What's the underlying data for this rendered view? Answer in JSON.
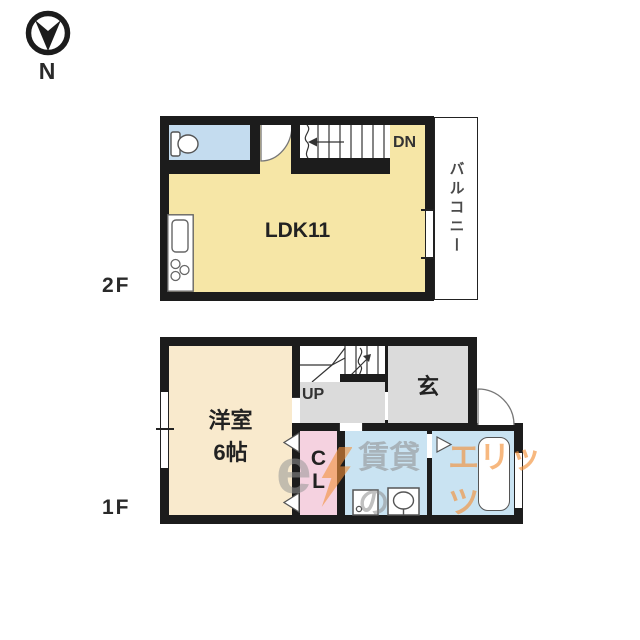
{
  "compass": {
    "label": "N"
  },
  "floor2": {
    "label": "2F",
    "ldk_label": "LDK11",
    "stairs_label": "DN",
    "balcony_label": "バルコニー"
  },
  "floor1": {
    "label": "1F",
    "room_label": "洋室",
    "room_size": "6帖",
    "stairs_label": "UP",
    "entrance_label": "玄",
    "closet_line1": "C",
    "closet_line2": "L"
  },
  "watermark": {
    "logo": "e",
    "gray_text": "賃貸の",
    "orange_text": "エリッツ"
  },
  "colors": {
    "wall": "#1c1c1c",
    "ldk_yellow": "#f6e6a6",
    "cream": "#f9eacd",
    "toilet_blue": "#c4dcef",
    "water_blue": "#c9e3f2",
    "closet_pink": "#f5d2e0",
    "hall_gray": "#dbdbdb",
    "orange": "#f3923b",
    "watermark_gray": "#9a9a9a"
  }
}
